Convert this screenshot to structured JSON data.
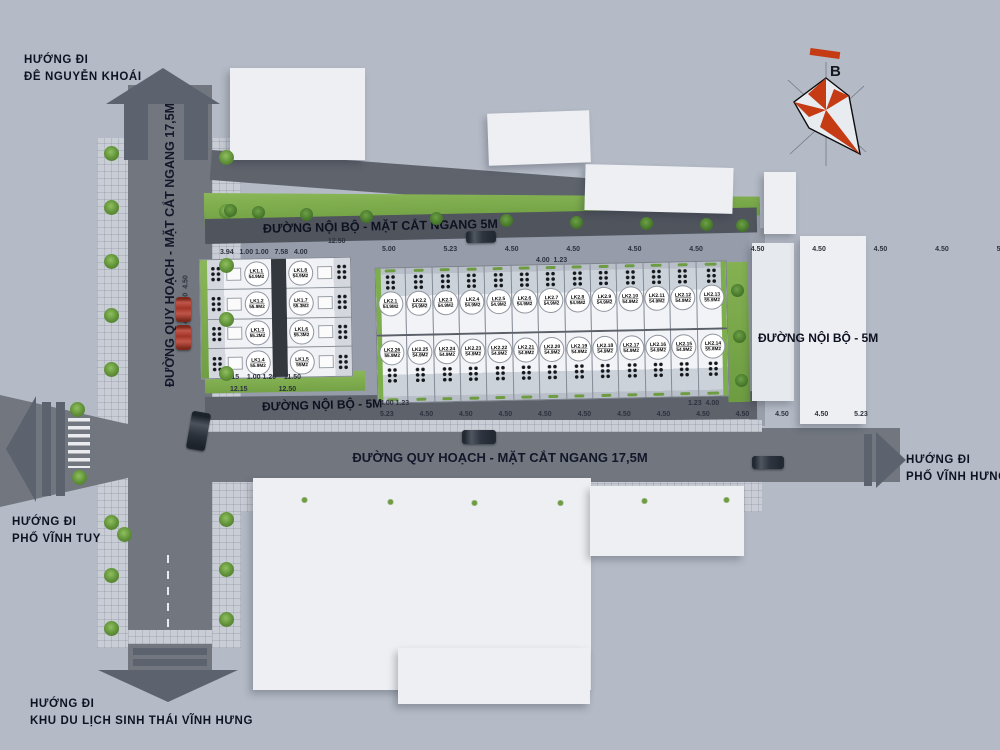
{
  "plan": {
    "north_label": "B",
    "directions": {
      "top": [
        "HƯỚNG ĐI",
        "ĐÊ NGUYỄN KHOÁI"
      ],
      "left": [
        "HƯỚNG ĐI",
        "PHỐ VĨNH TUY"
      ],
      "right": [
        "HƯỚNG ĐI",
        "PHỐ VĨNH HƯNG"
      ],
      "bottom": [
        "HƯỚNG ĐI",
        "KHU DU LỊCH SINH THÁI VĨNH HƯNG"
      ]
    },
    "roads": {
      "vertical_main": "ĐƯỜNG QUY HOẠCH - MẶT CẮT NGANG 17,5M",
      "horizontal_main": "ĐƯỜNG QUY HOẠCH - MẶT CẮT NGANG 17,5M",
      "internal_top": "ĐƯỜNG NỘI BỘ - MẶT CẮT NGANG 5M",
      "internal_left": "ĐƯỜNG NỘI BỘ - 5M",
      "internal_right": "ĐƯỜNG NỘI BỘ - 5M"
    },
    "block1": {
      "col_left": [
        {
          "id": "LK1.1",
          "area": "54.9M2"
        },
        {
          "id": "LK1.2",
          "area": "55.9M2"
        },
        {
          "id": "LK1.3",
          "area": "55.2M2"
        },
        {
          "id": "LK1.4",
          "area": "55.9M2"
        }
      ],
      "col_right": [
        {
          "id": "LK1.8",
          "area": "54.9M2"
        },
        {
          "id": "LK1.7",
          "area": "55.3M2"
        },
        {
          "id": "LK1.6",
          "area": "55.3M2"
        },
        {
          "id": "LK1.5",
          "area": "55M2"
        }
      ]
    },
    "block2": {
      "row_top": [
        {
          "id": "LK2.1",
          "area": "54.9M2"
        },
        {
          "id": "LK2.2",
          "area": "54.9M2"
        },
        {
          "id": "LK2.3",
          "area": "54.9M2"
        },
        {
          "id": "LK2.4",
          "area": "54.9M2"
        },
        {
          "id": "LK2.5",
          "area": "54.9M2"
        },
        {
          "id": "LK2.6",
          "area": "54.9M2"
        },
        {
          "id": "LK2.7",
          "area": "54.9M2"
        },
        {
          "id": "LK2.8",
          "area": "54.9M2"
        },
        {
          "id": "LK2.9",
          "area": "54.9M2"
        },
        {
          "id": "LK2.10",
          "area": "54.9M2"
        },
        {
          "id": "LK2.11",
          "area": "54.9M2"
        },
        {
          "id": "LK2.12",
          "area": "54.9M2"
        },
        {
          "id": "LK2.13",
          "area": "55.9M2"
        }
      ],
      "row_bottom": [
        {
          "id": "LK2.26",
          "area": "55.9M2"
        },
        {
          "id": "LK2.25",
          "area": "54.9M2"
        },
        {
          "id": "LK2.24",
          "area": "54.9M2"
        },
        {
          "id": "LK2.23",
          "area": "54.9M2"
        },
        {
          "id": "LK2.22",
          "area": "54.9M2"
        },
        {
          "id": "LK2.21",
          "area": "54.9M2"
        },
        {
          "id": "LK2.20",
          "area": "54.9M2"
        },
        {
          "id": "LK2.19",
          "area": "54.9M2"
        },
        {
          "id": "LK2.18",
          "area": "54.9M2"
        },
        {
          "id": "LK2.17",
          "area": "54.9M2"
        },
        {
          "id": "LK2.16",
          "area": "54.9M2"
        },
        {
          "id": "LK2.15",
          "area": "54.9M2"
        },
        {
          "id": "LK2.14",
          "area": "55.8M2"
        }
      ]
    },
    "dimensions": {
      "block1_top": "3.94   1.00 1.00   7.58   4.00",
      "block2_gap": "12.50",
      "block2_top": "5.00   5.23   4.50   4.50   4.50   4.50   4.50   4.50   4.50   4.50   5.23",
      "block2_top_b": "4.00  1.23",
      "block1_left": "4.60  4.50  4.50",
      "block1_bottom_a": "11.15    1.00 1.20    11.50",
      "block1_bottom_b": "12.15                12.50",
      "block2_bottom_a": "4.00 1.23",
      "block2_bottom_b": "1.23  4.00",
      "block2_bottom": "5.23  4.50  4.50  4.50  4.50  4.50  4.50  4.50  4.50  4.50  4.50  4.50  5.23"
    },
    "colors": {
      "accent_green": "#7cae4b",
      "compass_orange": "#c43b14",
      "road_gray": "#71767f"
    }
  }
}
